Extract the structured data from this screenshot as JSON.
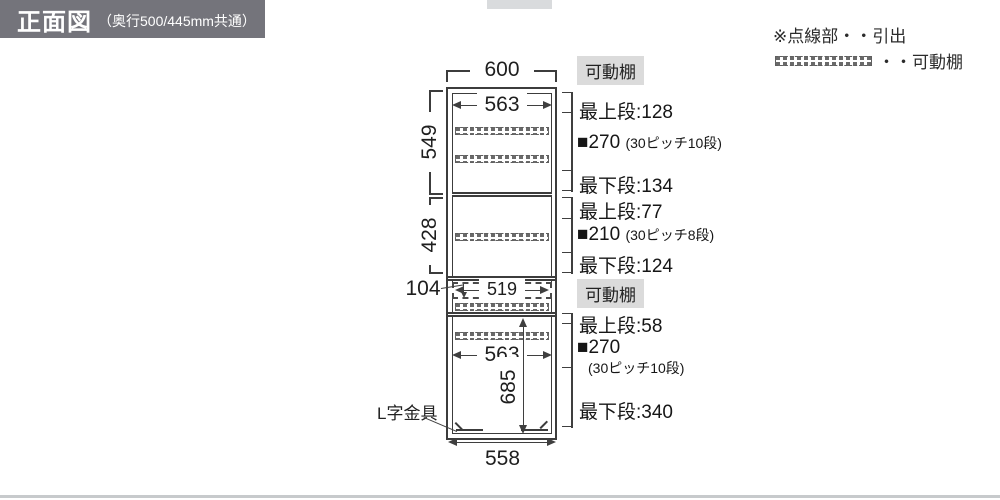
{
  "header": {
    "title": "正面図",
    "subtitle": "（奥行500/445mm共通）",
    "bg_color": "#74747b"
  },
  "legend": {
    "drawer_note": "※点線部・・引出",
    "shelf_note": "・・可動棚"
  },
  "diagram": {
    "dim_top_width": "600",
    "dim_upper_inner_width": "563",
    "dim_upper_height": "549",
    "dim_middle_height": "428",
    "dim_drawer_height": "104",
    "dim_drawer_width": "519",
    "dim_lower_inner_width": "563",
    "dim_lower_height": "685",
    "dim_bottom_width": "558",
    "l_bracket_label": "L字金具",
    "line_color": "#3c3c3c"
  },
  "annotations": {
    "movable_shelf_label_upper": "可動棚",
    "movable_shelf_label_lower": "可動棚",
    "badge_bg_color": "#dbdbdb",
    "upper_section": {
      "top": "最上段:128",
      "pitch": "■270",
      "pitch_note": "(30ピッチ10段)",
      "bottom": "最下段:134"
    },
    "middle_section": {
      "top": "最上段:77",
      "pitch": "■210",
      "pitch_note": "(30ピッチ8段)",
      "bottom": "最下段:124"
    },
    "lower_section": {
      "top": "最上段:58",
      "pitch": "■270",
      "pitch_note": "(30ピッチ10段)",
      "bottom": "最下段:340"
    }
  }
}
